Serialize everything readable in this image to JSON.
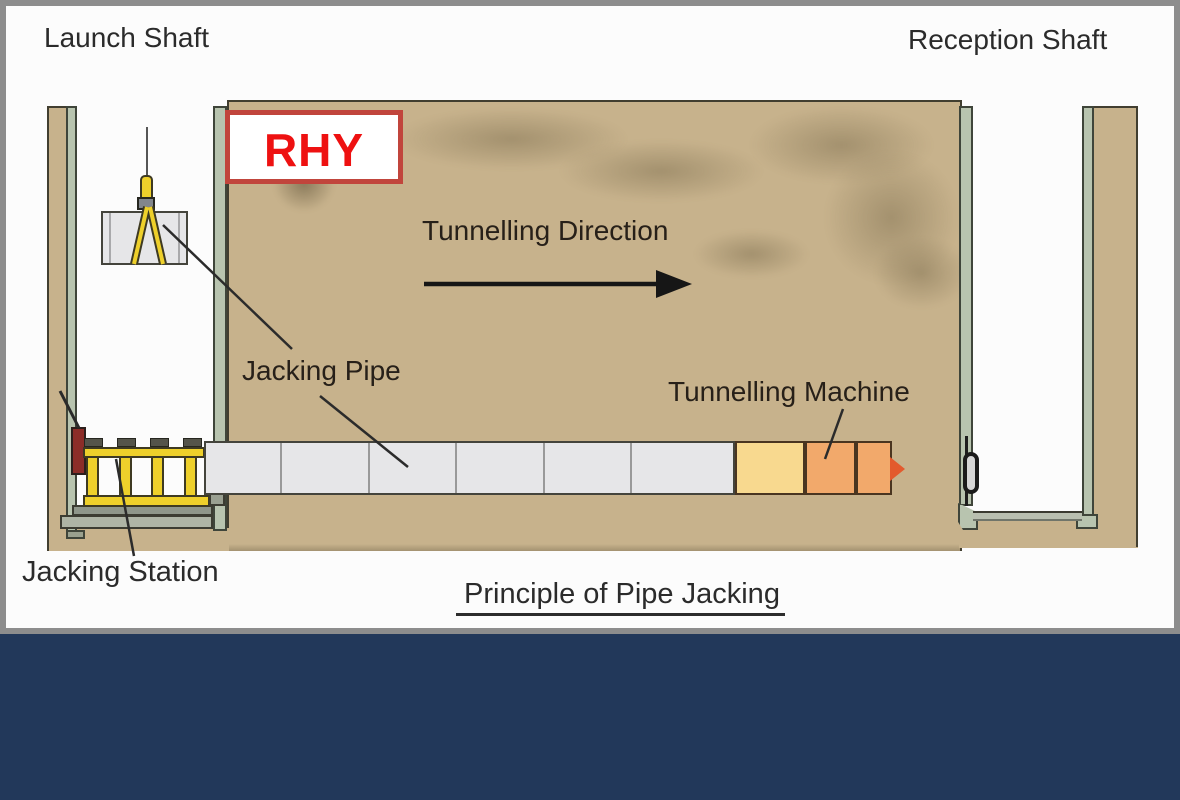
{
  "diagram": {
    "caption": "Principle of Pipe Jacking",
    "watermark": "RHY",
    "labels": {
      "launch_shaft": "Launch Shaft",
      "reception_shaft": "Reception Shaft",
      "tunnelling_direction": "Tunnelling Direction",
      "jacking_pipe": "Jacking Pipe",
      "tunnelling_machine": "Tunnelling Machine",
      "jacking_station": "Jacking Station"
    },
    "colors": {
      "soil": "#c7b28c",
      "shaft_liner": "#b8c4af",
      "pipe_concrete": "#e6e6e8",
      "station_yellow": "#eed02b",
      "machine_shield_yellow": "#f8d98f",
      "machine_body_orange": "#f2a96b",
      "machine_cutter_red": "#e35a2d",
      "hydraulic_ram_red": "#8c2d28",
      "watermark_text_red": "#ee1111",
      "watermark_border_red": "#c1453c",
      "footer_navy": "#22385a",
      "frame_gray": "#8d8d8d",
      "label_text": "#2b2b2b"
    }
  }
}
